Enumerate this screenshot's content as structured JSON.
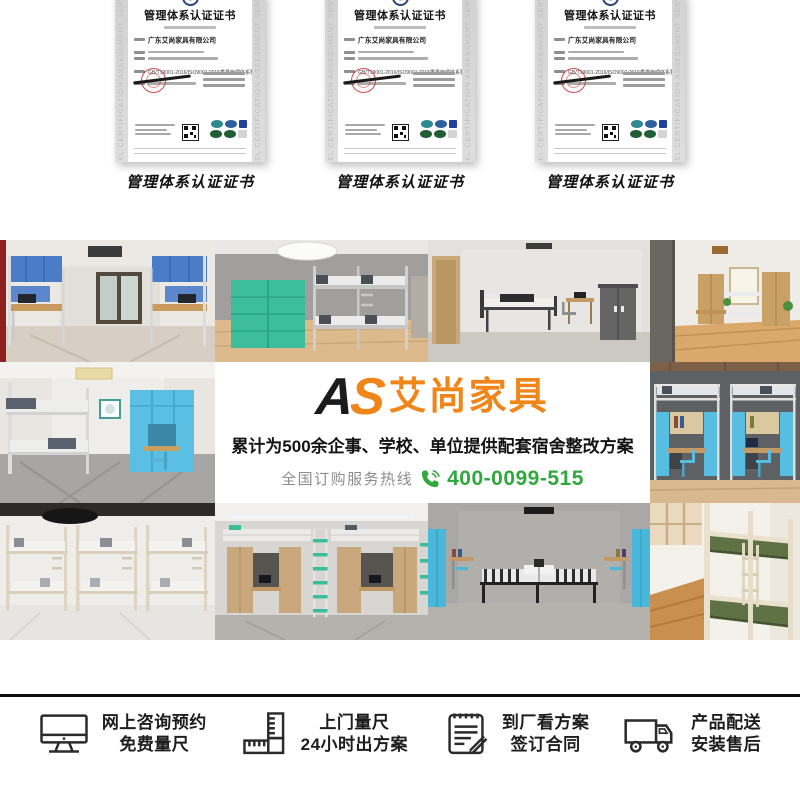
{
  "certificates": {
    "caption": "管理体系认证证书",
    "title": "管理体系认证证书",
    "company": "广东艾尚家具有限公司",
    "standard_line": "GB/T19001-2016/ISO9001:2015质量管理体系要求",
    "side_text": "ANGEL CERTIFICATION ASSESSMENT SERVICES"
  },
  "banner": {
    "logo_a": "A",
    "logo_s": "S",
    "brand_name": "艾尚家具",
    "headline": "累计为500余企事、学校、单位提供配套宿舍整改方案",
    "hotline_label": "全国订购服务热线",
    "hotline_number": "400-0099-515",
    "colors": {
      "brand_orange": "#f0851a",
      "hotline_green": "#2fa83c",
      "logo_black": "#1b1b1b"
    }
  },
  "services": [
    {
      "icon": "monitor-icon",
      "line1": "网上咨询预约",
      "line2": "免费量尺"
    },
    {
      "icon": "ruler-icon",
      "line1": "上门量尺",
      "line2": "24小时出方案"
    },
    {
      "icon": "contract-icon",
      "line1": "到厂看方案",
      "line2": "签订合同"
    },
    {
      "icon": "truck-icon",
      "line1": "产品配送",
      "line2": "安装售后"
    }
  ]
}
